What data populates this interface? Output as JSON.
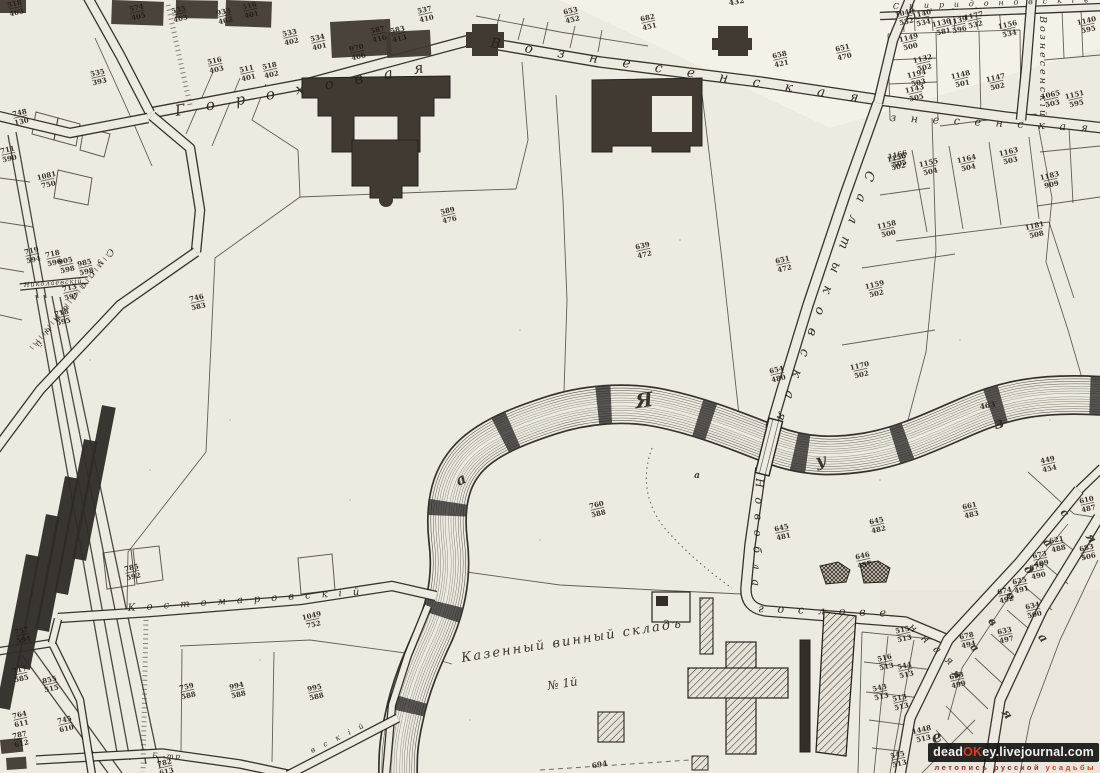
{
  "colors": {
    "paper": "#edeae1",
    "ink": "#2b2722",
    "parcel_line": "#3b362f",
    "dark_building": "#403a33",
    "accent_red": "#e2392b",
    "tag_red": "#8d2e26"
  },
  "watermark": {
    "site_prefix": "dead",
    "site_accent": "OK",
    "site_suffix": "ey.livejournal.com",
    "tagline_left": "летопись русской",
    "tagline_right": "усадьбы"
  },
  "map": {
    "annotation": {
      "line1": "Казенный винный складъ",
      "line2": "№ 1й"
    },
    "street_labels": [
      {
        "id": "gorokhovaya",
        "text": "Гороховая",
        "x": 176,
        "y": 116,
        "r": -10,
        "s": 15,
        "len": 252
      },
      {
        "id": "voznesenskaya",
        "text": "Вознесенская",
        "x": 490,
        "y": 47,
        "r": 8.5,
        "s": 13.5,
        "len": 372
      },
      {
        "id": "voznesenskaya-east",
        "text": "знесенская",
        "x": 890,
        "y": 121,
        "r": 3,
        "s": 11,
        "len": 198
      },
      {
        "id": "voznesensky-lane",
        "text": "Вознесенскій",
        "x": 1040,
        "y": 16,
        "r": 90,
        "s": 9.5,
        "len": 100
      },
      {
        "id": "spiridonovsky",
        "text": "Спиридоновскіе",
        "x": 893,
        "y": 9,
        "r": -2,
        "s": 8,
        "len": 196
      },
      {
        "id": "saltykovskaya",
        "text": "Салтыковская",
        "x": 867,
        "y": 170,
        "r": 110,
        "s": 13,
        "len": 265
      },
      {
        "id": "novoblagoslovennaya-1",
        "text": "Новобла",
        "x": 756,
        "y": 478,
        "r": 92,
        "s": 11,
        "len": 108
      },
      {
        "id": "novoblagoslovennaya-2",
        "text": "гослове",
        "x": 758,
        "y": 612,
        "r": 2,
        "s": 11,
        "len": 128
      },
      {
        "id": "novoblagoslovennaya-3",
        "text": "нная",
        "x": 908,
        "y": 628,
        "r": 42,
        "s": 11,
        "len": 56
      },
      {
        "id": "kostomarovsky",
        "text": "Костомаровскій",
        "x": 128,
        "y": 611,
        "r": -4,
        "s": 10,
        "len": 232
      },
      {
        "id": "susalny",
        "text": "Сусальный",
        "x": 110,
        "y": 248,
        "r": 128,
        "s": 9,
        "len": 122
      },
      {
        "id": "nikolaevsky",
        "text": "Николаевскій",
        "x": 24,
        "y": 287,
        "r": -4,
        "s": 6.5,
        "len": 58
      },
      {
        "id": "b-tr",
        "text": "Б.-тр",
        "x": 152,
        "y": 758,
        "r": 2,
        "s": 7.5,
        "len": 28
      },
      {
        "id": "b-tr-2",
        "text": "вскій",
        "x": 312,
        "y": 753,
        "r": -26,
        "s": 7.5,
        "len": 58
      }
    ],
    "scatter_letters": [
      {
        "ch": "а",
        "x": 463,
        "y": 484,
        "r": -25,
        "s": 15
      },
      {
        "ch": "Я",
        "x": 645,
        "y": 407,
        "r": -8,
        "s": 20
      },
      {
        "ch": "у",
        "x": 822,
        "y": 466,
        "r": -12,
        "s": 17
      },
      {
        "ch": "з",
        "x": 1000,
        "y": 428,
        "r": -15,
        "s": 15
      },
      {
        "ch": "a",
        "x": 697,
        "y": 478,
        "r": 0,
        "s": 9
      },
      {
        "ch": "с",
        "x": 1062,
        "y": 515,
        "r": 50,
        "s": 11
      },
      {
        "ch": "а",
        "x": 1045,
        "y": 545,
        "r": 50,
        "s": 11
      },
      {
        "ch": "д",
        "x": 1026,
        "y": 572,
        "r": 50,
        "s": 11
      },
      {
        "ch": "о",
        "x": 1008,
        "y": 598,
        "r": 50,
        "s": 11
      },
      {
        "ch": "в",
        "x": 990,
        "y": 624,
        "r": 50,
        "s": 11
      },
      {
        "ch": "а",
        "x": 972,
        "y": 650,
        "r": 50,
        "s": 11
      },
      {
        "ch": "я",
        "x": 954,
        "y": 676,
        "r": 50,
        "s": 11
      },
      {
        "ch": "я",
        "x": 1088,
        "y": 540,
        "r": 55,
        "s": 12
      },
      {
        "ch": "а",
        "x": 1040,
        "y": 640,
        "r": 55,
        "s": 12
      },
      {
        "ch": "я",
        "x": 1004,
        "y": 716,
        "r": 55,
        "s": 12
      },
      {
        "ch": "е",
        "x": 938,
        "y": 742,
        "r": -15,
        "s": 16
      }
    ],
    "plain_numbers": [
      {
        "text": "694",
        "x": 600,
        "y": 767
      },
      {
        "text": "463",
        "x": 988,
        "y": 408
      },
      {
        "text": "432",
        "x": 737,
        "y": 4
      }
    ],
    "parcel_numbers": [
      [
        "535",
        "403",
        179,
        12
      ],
      [
        "933",
        "402",
        224,
        14
      ],
      [
        "516",
        "401",
        250,
        8
      ],
      [
        "533",
        "402",
        290,
        35
      ],
      [
        "534",
        "401",
        318,
        40
      ],
      [
        "970",
        "406",
        357,
        50
      ],
      [
        "587",
        "416",
        378,
        32
      ],
      [
        "583",
        "413",
        398,
        32
      ],
      [
        "537",
        "410",
        425,
        12
      ],
      [
        "518",
        "403",
        15,
        6
      ],
      [
        "574",
        "405",
        137,
        10
      ],
      [
        "516",
        "403",
        215,
        63
      ],
      [
        "511",
        "401",
        247,
        71
      ],
      [
        "518",
        "402",
        270,
        68
      ],
      [
        "535",
        "393",
        98,
        75
      ],
      [
        "711",
        "590",
        8,
        152
      ],
      [
        "1081",
        "750",
        47,
        178
      ],
      [
        "748",
        "130",
        20,
        115
      ],
      [
        "719",
        "594",
        32,
        253
      ],
      [
        "718",
        "596",
        53,
        256
      ],
      [
        "905",
        "598",
        66,
        263
      ],
      [
        "985",
        "598",
        85,
        265
      ],
      [
        "713",
        "597",
        70,
        290
      ],
      [
        "718",
        "595",
        62,
        315
      ],
      [
        "746",
        "583",
        197,
        300
      ],
      [
        "653",
        "452",
        571,
        13
      ],
      [
        "682",
        "451",
        648,
        20
      ],
      [
        "658",
        "421",
        780,
        57
      ],
      [
        "651",
        "470",
        843,
        50
      ],
      [
        "589",
        "476",
        448,
        213
      ],
      [
        "639",
        "472",
        643,
        248
      ],
      [
        "651",
        "472",
        783,
        262
      ],
      [
        "654",
        "480",
        777,
        372
      ],
      [
        "1156",
        "502",
        897,
        160
      ],
      [
        "1158",
        "500",
        887,
        227
      ],
      [
        "1159",
        "502",
        875,
        287
      ],
      [
        "1170",
        "502",
        860,
        368
      ],
      [
        "1040",
        "532",
        905,
        15
      ],
      [
        "1140",
        "534",
        922,
        16
      ],
      [
        "1130",
        "581",
        942,
        25
      ],
      [
        "1139",
        "596",
        958,
        23
      ],
      [
        "1177",
        "532",
        974,
        18
      ],
      [
        "1156",
        "534",
        1008,
        27
      ],
      [
        "1149",
        "500",
        909,
        40
      ],
      [
        "1132",
        "502",
        923,
        61
      ],
      [
        "1194",
        "503",
        917,
        76
      ],
      [
        "1143",
        "505",
        915,
        91
      ],
      [
        "1148",
        "501",
        961,
        77
      ],
      [
        "1147",
        "502",
        996,
        80
      ],
      [
        "1065",
        "503",
        1051,
        97
      ],
      [
        "1151",
        "595",
        1075,
        97
      ],
      [
        "1140",
        "595",
        1087,
        23
      ],
      [
        "1166",
        "505",
        898,
        157
      ],
      [
        "1155",
        "504",
        929,
        165
      ],
      [
        "1164",
        "504",
        967,
        161
      ],
      [
        "1163",
        "503",
        1009,
        154
      ],
      [
        "1183",
        "909",
        1050,
        178
      ],
      [
        "1181",
        "508",
        1035,
        228
      ],
      [
        "449",
        "454",
        1048,
        462
      ],
      [
        "661",
        "483",
        970,
        508
      ],
      [
        "645",
        "481",
        782,
        530
      ],
      [
        "645",
        "482",
        877,
        523
      ],
      [
        "646",
        "457",
        863,
        558
      ],
      [
        "610",
        "487",
        1087,
        502
      ],
      [
        "621",
        "488",
        1057,
        542
      ],
      [
        "683",
        "506",
        1087,
        550
      ],
      [
        "673",
        "489",
        1040,
        557
      ],
      [
        "675",
        "490",
        1037,
        569
      ],
      [
        "625",
        "491",
        1020,
        583
      ],
      [
        "674",
        "492",
        1005,
        593
      ],
      [
        "634",
        "500",
        1033,
        608
      ],
      [
        "678",
        "494",
        967,
        638
      ],
      [
        "633",
        "497",
        1005,
        633
      ],
      [
        "693",
        "499",
        957,
        678
      ],
      [
        "1448",
        "513",
        922,
        732
      ],
      [
        "515",
        "513",
        903,
        632
      ],
      [
        "516",
        "513",
        885,
        660
      ],
      [
        "544",
        "513",
        905,
        668
      ],
      [
        "543",
        "513",
        880,
        690
      ],
      [
        "513",
        "513",
        900,
        700
      ],
      [
        "545",
        "513",
        898,
        757
      ],
      [
        "757",
        "594",
        22,
        633
      ],
      [
        "717",
        "585",
        20,
        672
      ],
      [
        "855",
        "515",
        50,
        682
      ],
      [
        "764",
        "611",
        20,
        717
      ],
      [
        "745",
        "610",
        65,
        722
      ],
      [
        "787",
        "612",
        20,
        737
      ],
      [
        "759",
        "588",
        187,
        689
      ],
      [
        "782",
        "613",
        165,
        765
      ],
      [
        "994",
        "588",
        237,
        688
      ],
      [
        "995",
        "588",
        315,
        690
      ],
      [
        "1049",
        "752",
        312,
        618
      ],
      [
        "785",
        "592",
        132,
        570
      ],
      [
        "760",
        "588",
        597,
        507
      ]
    ]
  }
}
